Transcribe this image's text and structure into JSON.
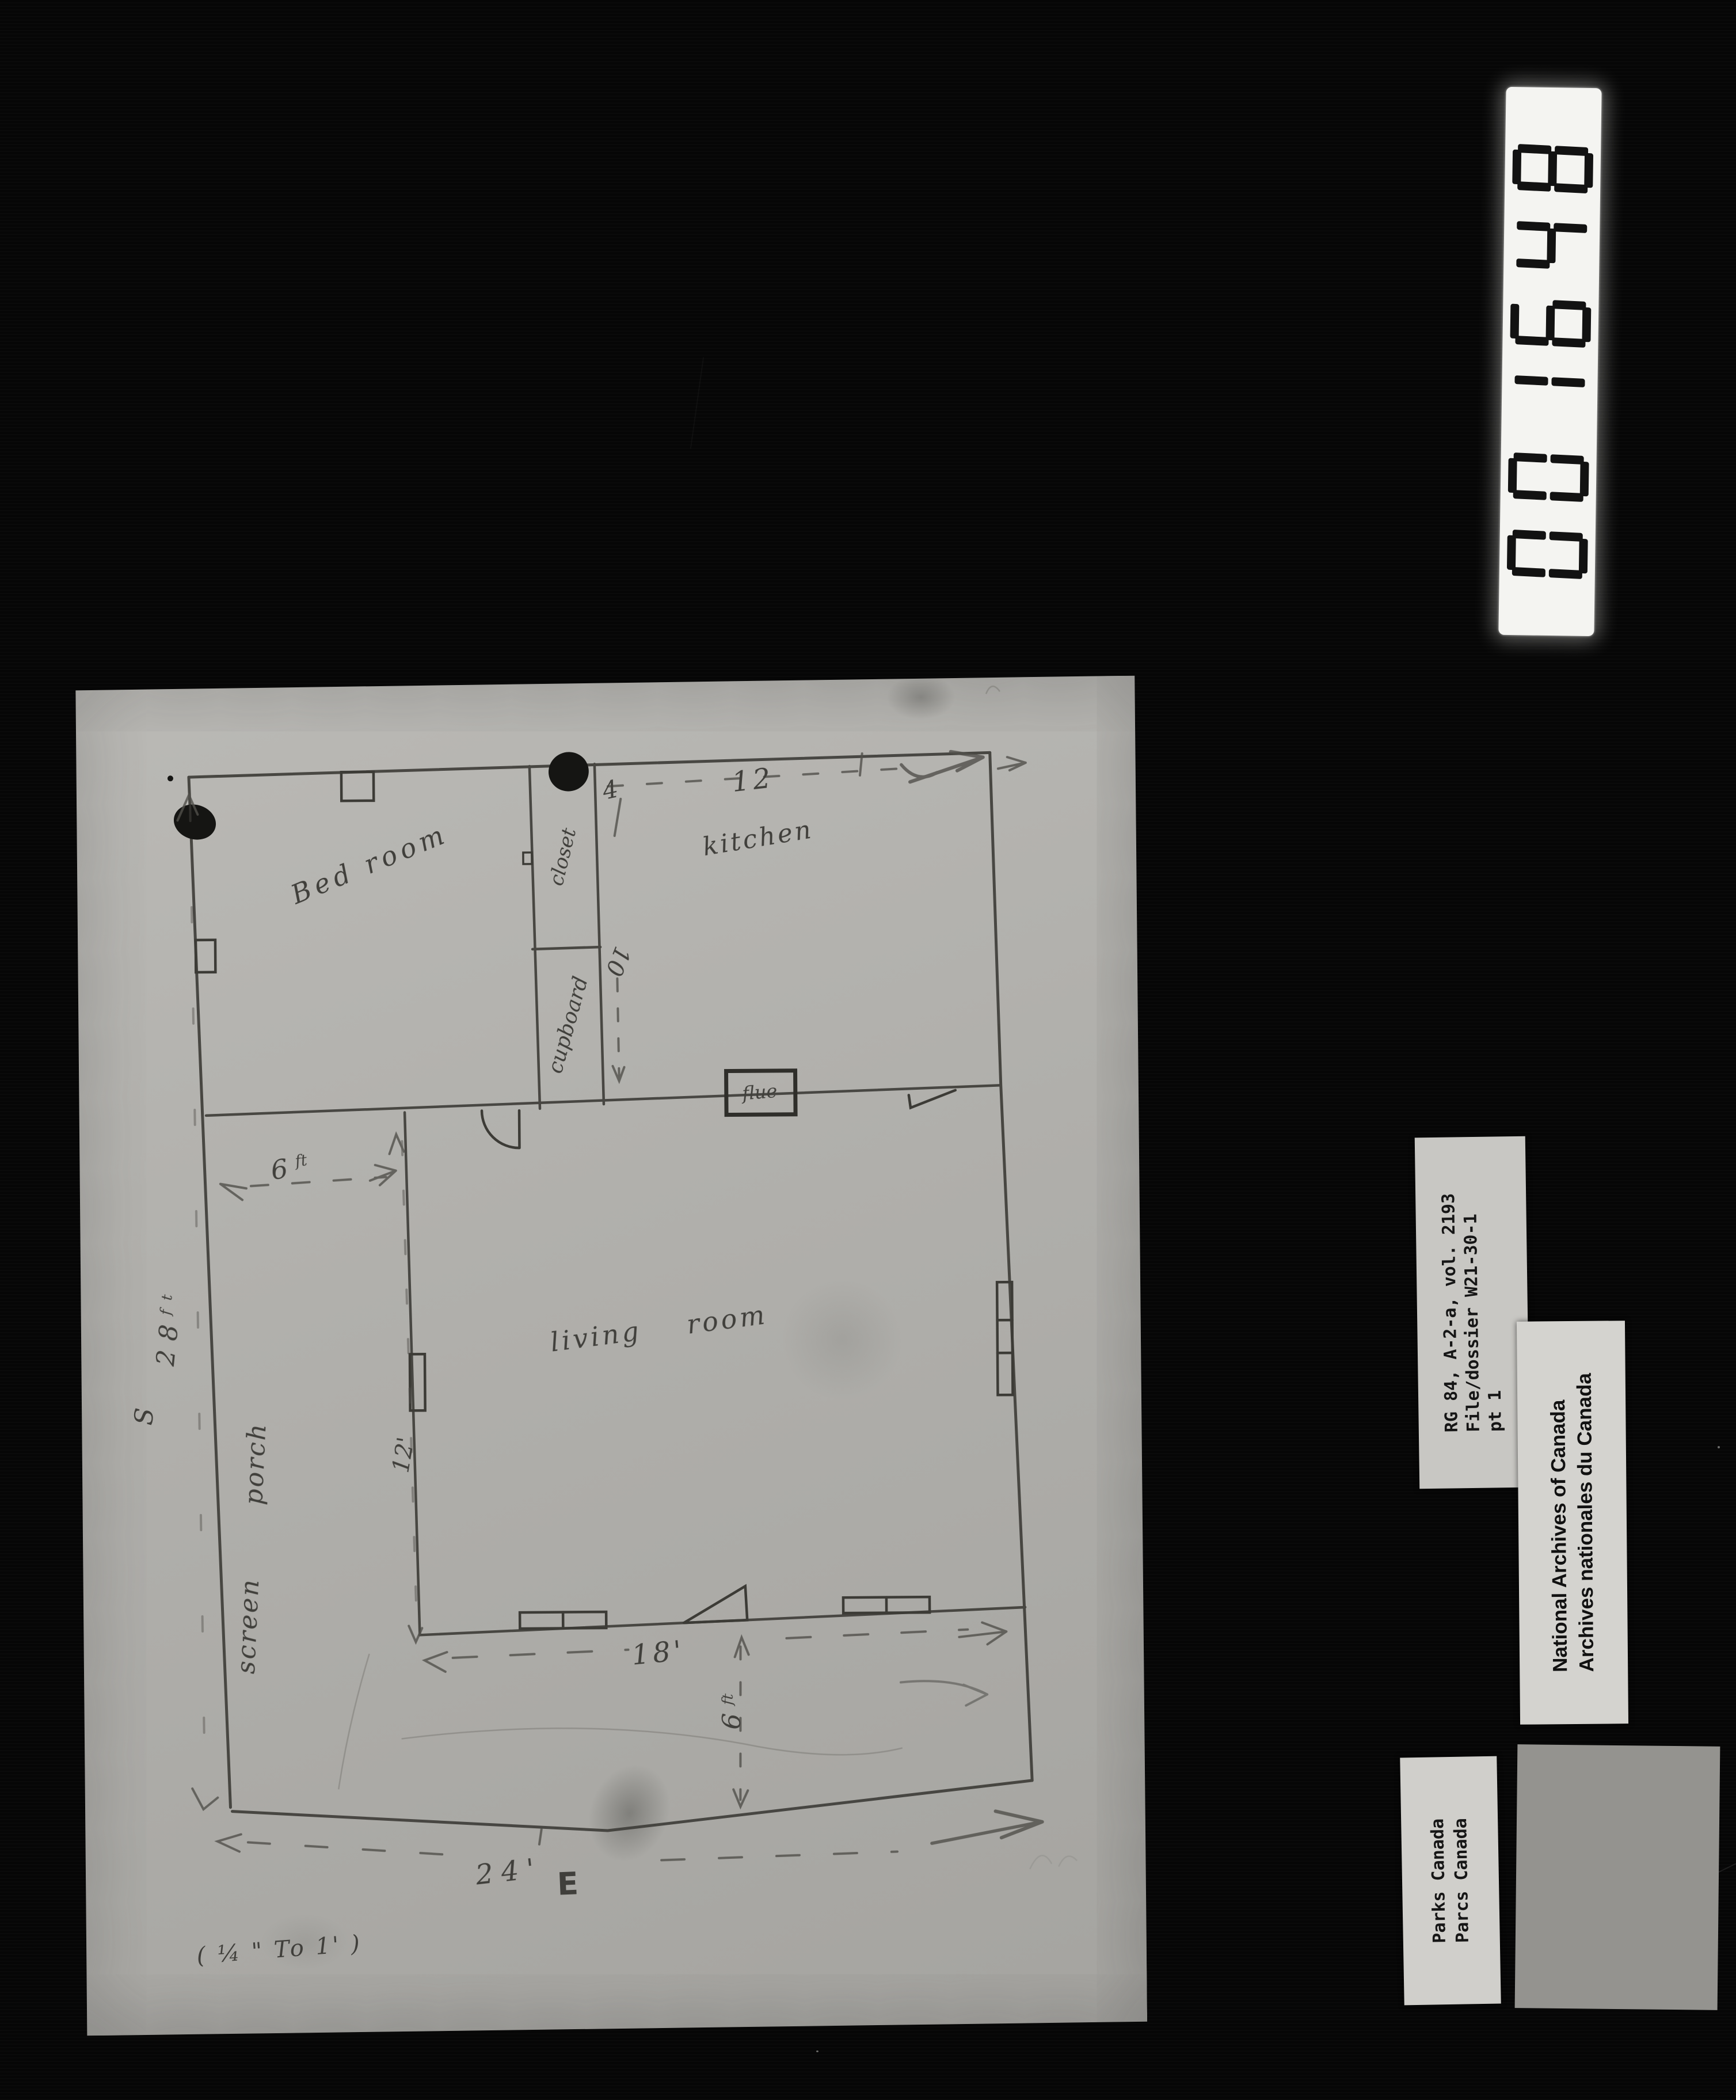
{
  "counter_strip": {
    "digits": "001648"
  },
  "archive_labels": {
    "reference": {
      "line1": "RG 84, A-2-a, vol. 2193",
      "line2": "File/dossier W21-30-1",
      "line3": "pt 1"
    },
    "institution": {
      "line1": "National Archives of Canada",
      "line2": "Archives nationales du Canada"
    },
    "agency": {
      "line1": "Parks Canada",
      "line2": "Parcs Canada"
    }
  },
  "plan": {
    "rooms": {
      "bedroom": "Bed room",
      "closet": "closet",
      "cupboard": "cupboard",
      "kitchen": "kitchen",
      "living_room": "living room",
      "porch": "screen porch",
      "flue": "flue"
    },
    "dims": {
      "closet_width": "4",
      "kitchen_width": "12",
      "closet_depth": "10",
      "porch_side": {
        "value": "6",
        "unit": "ft"
      },
      "living_depth": "12'",
      "living_width": "18'",
      "porch_bottom": {
        "value": "6",
        "unit": "ft"
      },
      "house_width": "24'",
      "house_depth": {
        "value": "28",
        "unit": "ft"
      }
    },
    "compass": {
      "south": "S",
      "east": "E"
    },
    "scale_note": "( ¼ \" To 1' )"
  }
}
